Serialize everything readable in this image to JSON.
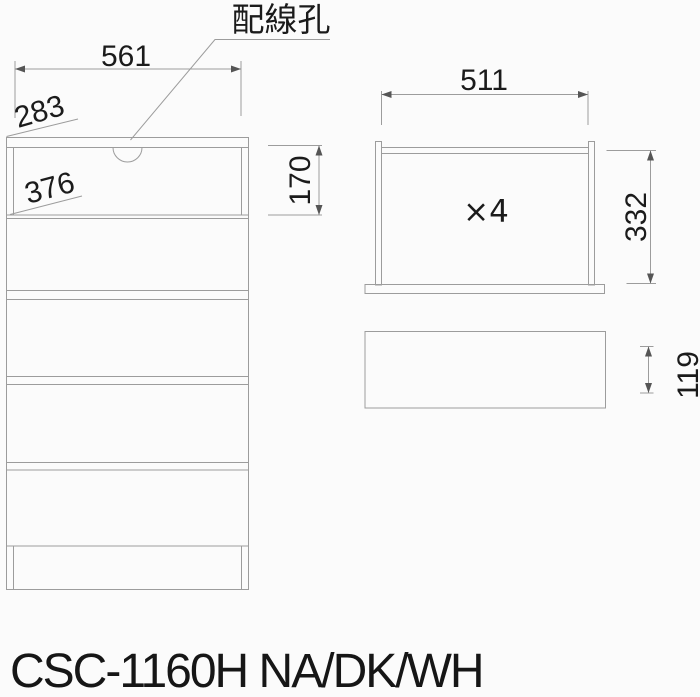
{
  "colors": {
    "background": "#fbfbfb",
    "line": "#9c9c9c",
    "arrowhead": "#555555",
    "text": "#1b1b1b"
  },
  "front_view": {
    "wiring_hole_label": "配線孔",
    "dim_width": "561",
    "dim_top_depth": "283",
    "dim_inner_depth": "376",
    "dim_open_section_height": "170"
  },
  "drawer_view": {
    "dim_width": "511",
    "dim_height": "332",
    "quantity_label": "×4",
    "dim_front_panel_height": "119"
  },
  "footer": {
    "model_label": "CSC-1160H NA/DK/WH"
  }
}
